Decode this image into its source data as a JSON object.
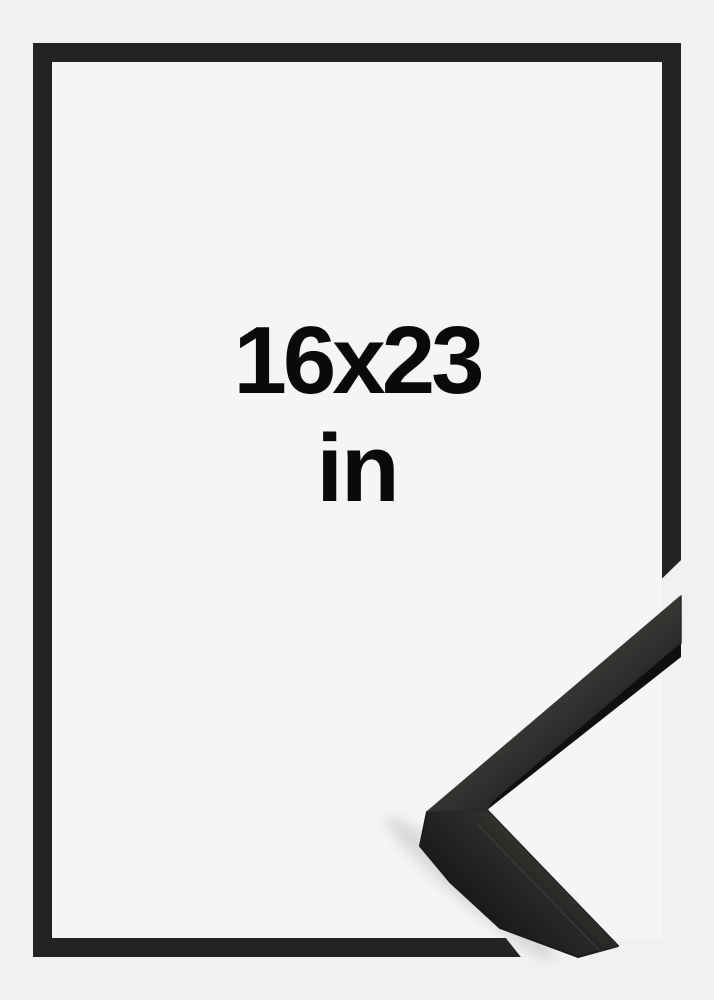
{
  "product": {
    "size": "16x23",
    "unit": "in"
  },
  "graphic": {
    "background_color": "#f1f1f2",
    "frame_interior_color": "#f5f5f6",
    "frame_border_color": "#232323",
    "text_color": "#0a0a0a",
    "corner_sample_surface_color": "#3d3b38",
    "corner_sample_shadow_color": "#101010"
  }
}
